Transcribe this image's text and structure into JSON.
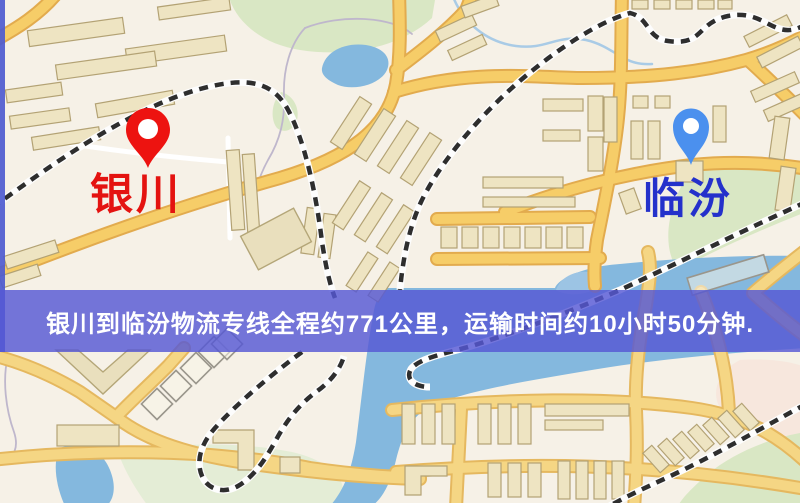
{
  "banner": {
    "text": "银川到临汾物流专线全程约771公里，运输时间约10小时50分钟.",
    "distance_text": "771公里",
    "duration_text": "10小时50分钟"
  },
  "map": {
    "origin": {
      "label": "银川",
      "pin": "red-map-pin"
    },
    "destination": {
      "label": "临汾",
      "pin": "blue-map-pin"
    }
  },
  "colors": {
    "banner_background": "#575bd6",
    "banner_text": "#ffffff",
    "origin_pin": "#ed1310",
    "origin_label": "#e41310",
    "destination_pin": "#4b90ee",
    "destination_label": "#2431cb",
    "road_major": "#f6cd68",
    "road_minor": "#ffffff",
    "water": "#84b8de",
    "park": "#d9e7c4",
    "building": "#eee4c2",
    "railway": "#2e2e2e",
    "map_background": "#f6f1e7"
  }
}
